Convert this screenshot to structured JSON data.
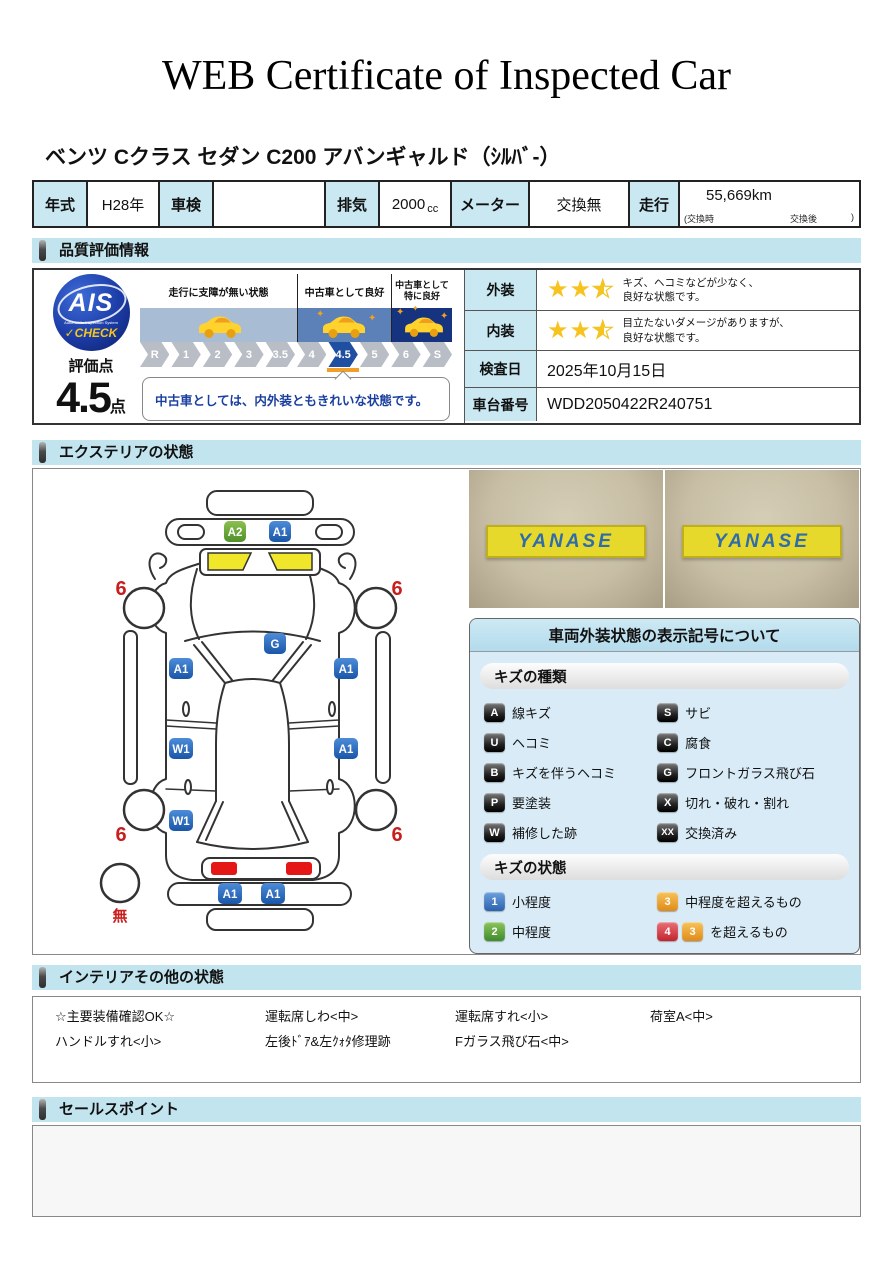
{
  "title": "WEB Certificate of Inspected Car",
  "car_name": "ベンツ Cクラス セダン C200 アバンギャルド（ｼﾙﾊﾞ-）",
  "spec": {
    "year_label": "年式",
    "year_value": "H28年",
    "inspection_label": "車検",
    "inspection_value": "",
    "displacement_label": "排気",
    "displacement_value": "2000",
    "displacement_unit": "cc",
    "meter_label": "メーター",
    "meter_value": "交換無",
    "mileage_label": "走行",
    "mileage_value": "55,669km",
    "mileage_note_open": "(交換時",
    "mileage_note_mid": "交換後",
    "mileage_note_close": ")"
  },
  "sections": {
    "quality": "品質評価情報",
    "exterior": "エクステリアの状態",
    "interior": "インテリアその他の状態",
    "sales": "セールスポイント"
  },
  "quality": {
    "ais": {
      "name": "AIS",
      "sub": "Automobile Inspection System",
      "check": "✓CHECK"
    },
    "score_label": "評価点",
    "score_value": "4.5",
    "score_unit": "点",
    "zones": [
      "走行に支障が無い状態",
      "中古車として良好",
      "中古車として\n特に良好"
    ],
    "scale": [
      "R",
      "1",
      "2",
      "3",
      "3.5",
      "4",
      "4.5",
      "5",
      "6",
      "S"
    ],
    "active_grade": "4.5",
    "comment": "中古車としては、内外装ともきれいな状態です。",
    "exterior_label": "外装",
    "exterior_stars": 2.5,
    "exterior_text": "キズ、ヘコミなどが少なく、\n良好な状態です。",
    "interior_label": "内装",
    "interior_stars": 2.5,
    "interior_text": "目立たないダメージがありますが、\n良好な状態です。",
    "inspection_date_label": "検査日",
    "inspection_date": "2025年10月15日",
    "vin_label": "車台番号",
    "vin": "WDD2050422R240751"
  },
  "exterior": {
    "photos": [
      {
        "sign": "YANASE"
      },
      {
        "sign": "YANASE"
      }
    ],
    "diagram": {
      "front_badge_a2": "A2",
      "front_badge_a1": "A1",
      "windshield": "G",
      "front_door_left": "A1",
      "front_door_right": "A1",
      "rear_door_left": "W1",
      "rear_door_right": "A1",
      "quarter_left": "W1",
      "rear_bumper_left": "A1",
      "rear_bumper_right": "A1",
      "tire_mark": "6",
      "spare_mark": "無"
    },
    "legend": {
      "title": "車両外装状態の表示記号について",
      "kinds_header": "キズの種類",
      "kinds": [
        {
          "code": "A",
          "label": "線キズ"
        },
        {
          "code": "S",
          "label": "サビ"
        },
        {
          "code": "U",
          "label": "ヘコミ"
        },
        {
          "code": "C",
          "label": "腐食"
        },
        {
          "code": "B",
          "label": "キズを伴うヘコミ"
        },
        {
          "code": "G",
          "label": "フロントガラス飛び石"
        },
        {
          "code": "P",
          "label": "要塗装"
        },
        {
          "code": "X",
          "label": "切れ・破れ・割れ"
        },
        {
          "code": "W",
          "label": "補修した跡"
        },
        {
          "code": "XX",
          "label": "交換済み"
        }
      ],
      "states_header": "キズの状態",
      "states": [
        {
          "code": "1",
          "label": "小程度"
        },
        {
          "code": "3",
          "label": "中程度を超えるもの"
        },
        {
          "code": "2",
          "label": "中程度"
        },
        {
          "code": "4",
          "code2": "3",
          "label": "を超えるもの"
        }
      ]
    }
  },
  "interior": {
    "items": [
      "☆主要装備確認OK☆",
      "運転席しわ<中>",
      "運転席すれ<小>",
      "荷室A<中>",
      "ハンドルすれ<小>",
      "左後ﾄﾞｱ&左ｸｫﾀ修理跡",
      "Fガラス飛び石<中>",
      ""
    ]
  },
  "colors": {
    "section_header_bg": "#C2E4EF",
    "label_cell_bg": "#C9E8F2",
    "badge_blue": "#2063B4",
    "badge_green": "#5FA032",
    "mark_red": "#C81E1E",
    "star_yellow": "#F7C31E",
    "scale_active": "#1E4FA0",
    "zone_light": "#A8BDD4",
    "zone_mid": "#5C80B8",
    "zone_dark": "#15337E",
    "legend_bg": "#D8EBF6",
    "sign_yellow": "#E7D82C",
    "sign_text_blue": "#2F6CAB",
    "taillight_red": "#E51616",
    "highlight_yellow": "#F0E62A"
  }
}
